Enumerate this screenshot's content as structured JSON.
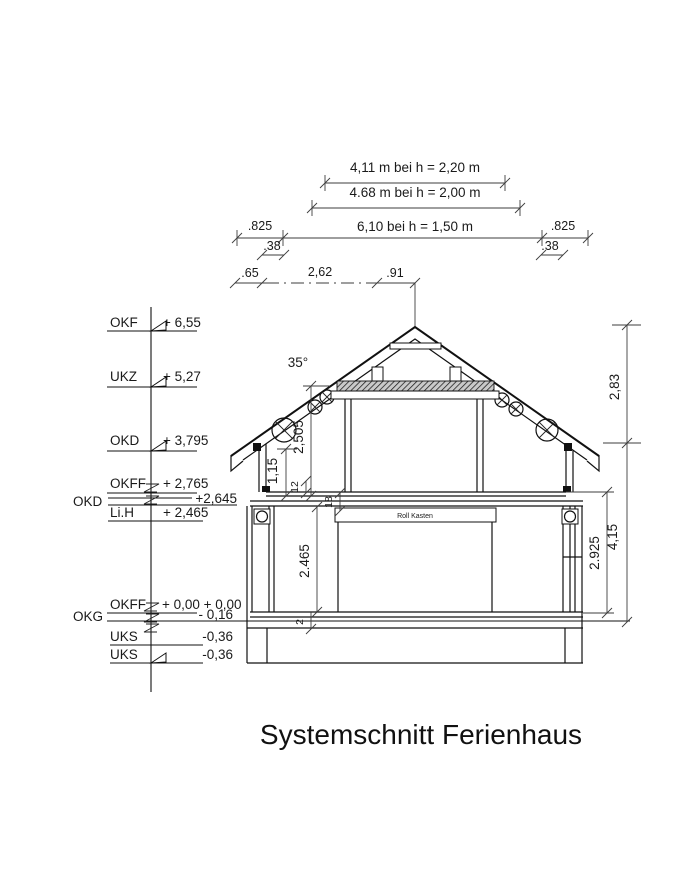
{
  "title": "Systemschnitt Ferienhaus",
  "top_dimensions": {
    "row1": "4,11 m bei h = 2,20 m",
    "row2": "4.68 m bei h = 2,00 m",
    "row3": "6,10 bei h = 1,50 m",
    "row3_left_offset": ".825",
    "row3_right_offset": ".825",
    "row3_left_sub": ".38",
    "row3_right_sub": ".38",
    "row4_left": ".65",
    "row4_mid": "2,62",
    "row4_right": ".91"
  },
  "levels": [
    {
      "label": "OKF",
      "value": "+ 6,55"
    },
    {
      "label": "UKZ",
      "value": "+ 5,27"
    },
    {
      "label": "OKD",
      "value": "+ 3,795"
    },
    {
      "label": "OKFF",
      "value": "+ 2,765"
    },
    {
      "label": "OKD",
      "value": "+2,645"
    },
    {
      "label": "Li.H",
      "value": "+ 2,465"
    },
    {
      "label": "OKFF",
      "value": "+ 0,00 + 0,00"
    },
    {
      "label": "OKG",
      "value": "- 0,16"
    },
    {
      "label": "UKS",
      "value": "-0,36"
    },
    {
      "label": "UKS",
      "value": "-0,36"
    }
  ],
  "vertical_dimensions": {
    "roof_height": "2,83",
    "right_total": "4,15",
    "right_inner": "2.925",
    "upper_room": "2,505",
    "knee_wall": "1,15",
    "floor_layer_top": "12",
    "floor_package": "18",
    "ground_room": "2.465",
    "slab": "2"
  },
  "roof_angle": "35°",
  "annotations": {
    "roll_kasten": "Roll Kasten"
  }
}
